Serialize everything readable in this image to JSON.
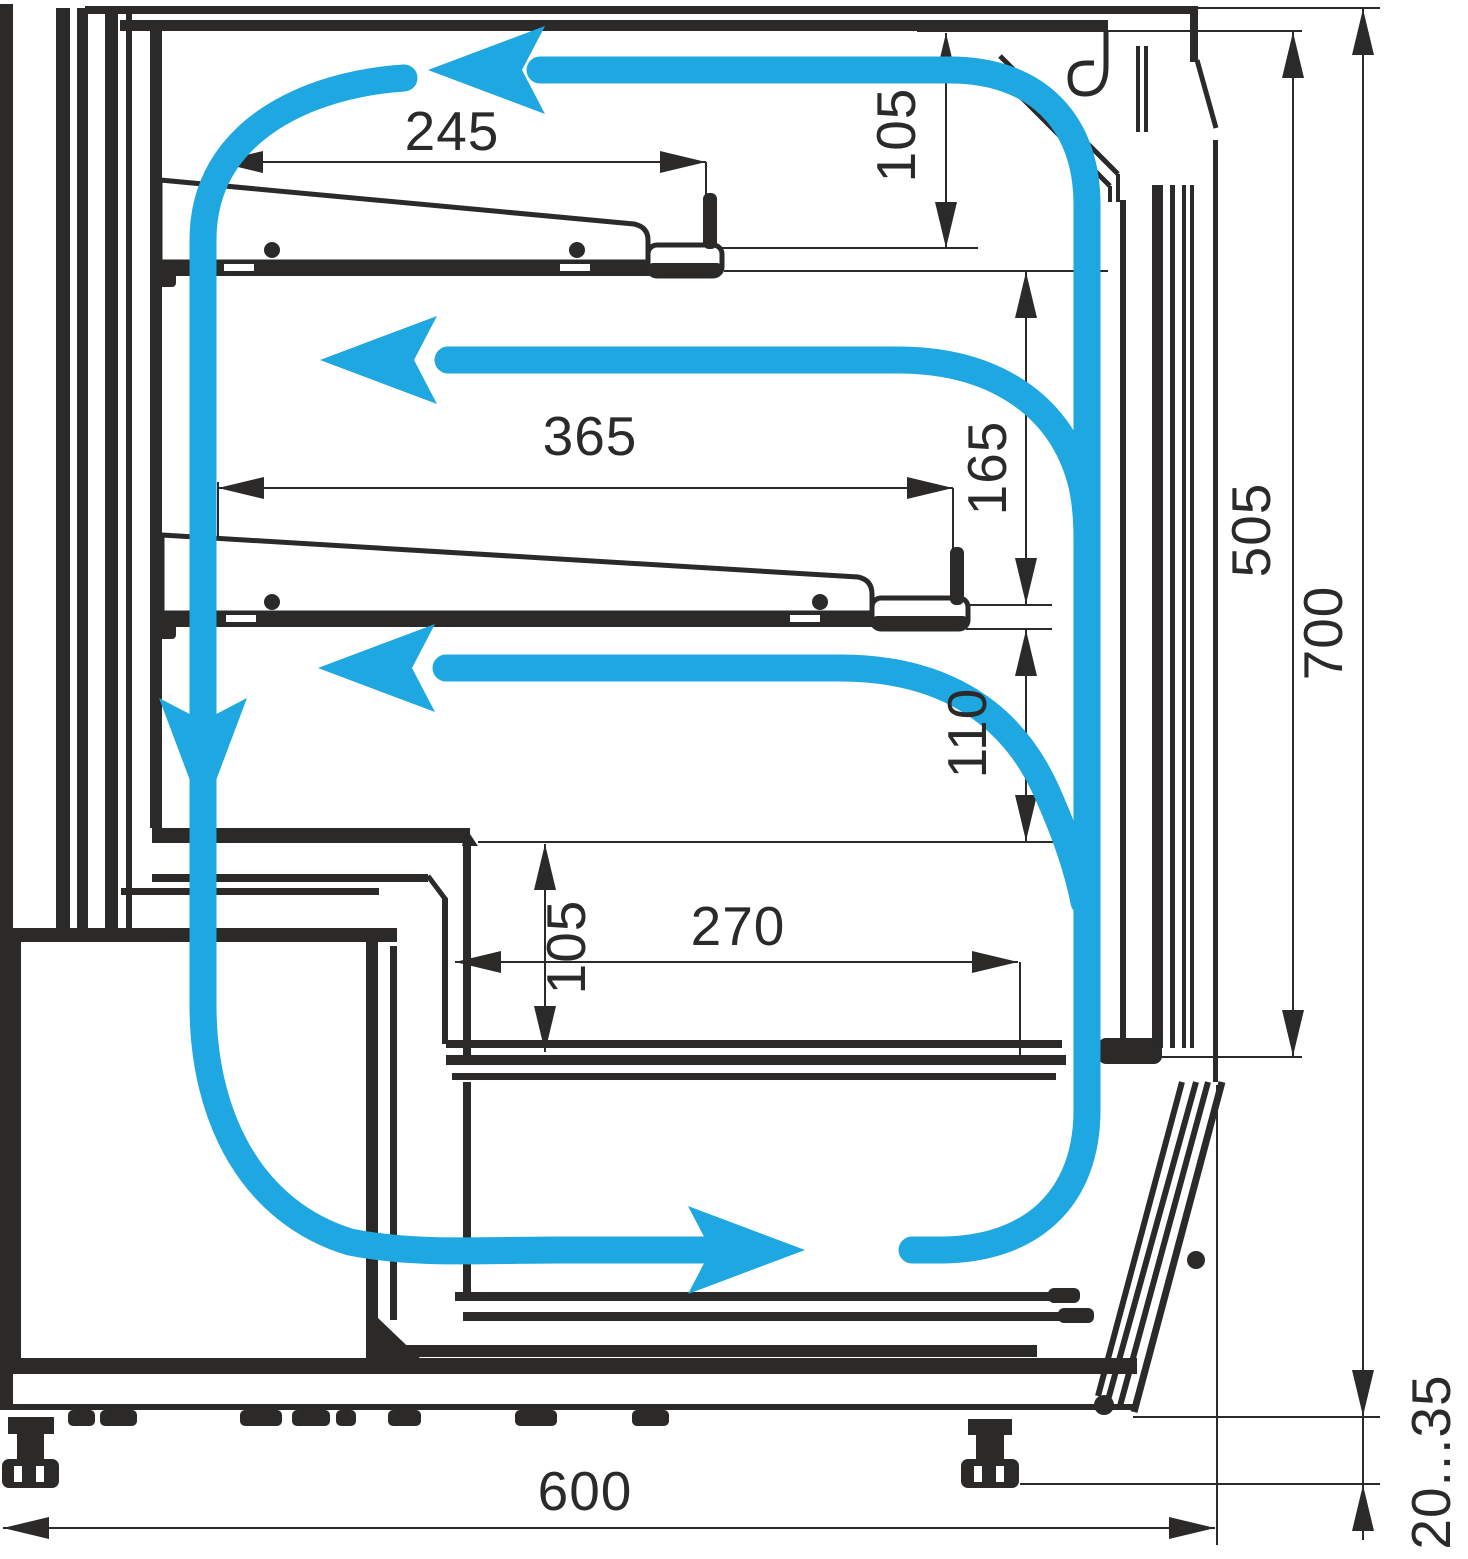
{
  "drawing": {
    "type": "refrigerated-display-case-cross-section-airflow-diagram",
    "units_shown": "mm"
  },
  "colors": {
    "airflow": "#1EA7E1",
    "line": "#2B2A29",
    "background": "#FFFFFF"
  },
  "dimensions": {
    "shelf_upper_depth": "245",
    "canopy_to_shelf_upper": "105",
    "shelf_lower_depth": "365",
    "shelf_upper_to_shelf_lower": "165",
    "opening_height": "505",
    "overall_inner_height": "700",
    "shelf_lower_to_step": "110",
    "step_height": "105",
    "well_depth": "270",
    "overall_depth": "600",
    "foot_adjustment_range": "20...35"
  }
}
